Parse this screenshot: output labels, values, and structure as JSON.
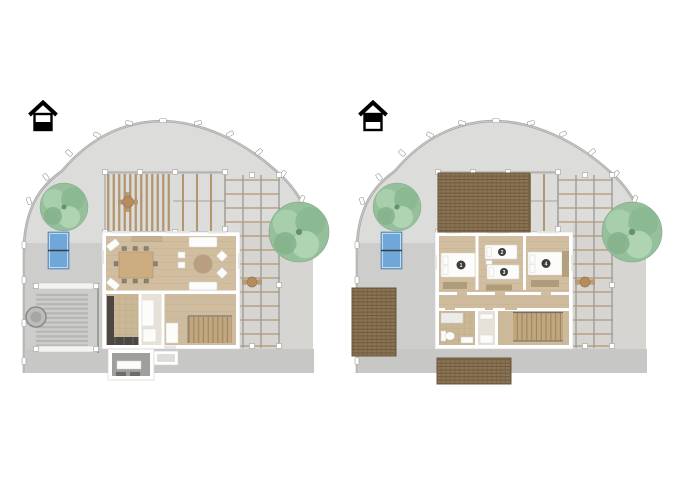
{
  "view": {
    "description": "Two 3D floor plans of a house on a fenced curved lot, side by side",
    "background": "#ffffff"
  },
  "floor_selector": {
    "ground": {
      "icon": "house-ground-floor-icon"
    },
    "upper": {
      "icon": "house-upper-floor-icon"
    }
  },
  "floors": [
    {
      "id": "ground-floor",
      "features": [
        "living-dining-room",
        "kitchen",
        "staircase",
        "entry-porch",
        "pergola",
        "trellis",
        "slat-carport",
        "table-tennis-table",
        "trees"
      ],
      "beds": []
    },
    {
      "id": "upper-floor",
      "features": [
        "bedroom-1",
        "bedroom-2-3",
        "bedroom-4",
        "bathroom",
        "staircase",
        "roof-sections",
        "pergola",
        "trellis",
        "table-tennis-table",
        "trees"
      ],
      "beds": [
        {
          "number": "1"
        },
        {
          "number": "2"
        },
        {
          "number": "3"
        },
        {
          "number": "4"
        }
      ]
    }
  ],
  "colors": {
    "paving_light": "#dcdcda",
    "paving_medium": "#cdcdcb",
    "paving_dark": "#c7c7c5",
    "paving_right": "#d6d5d1",
    "fence_gray": "#a9a9a7",
    "tree_green": "#96c09c",
    "table_tennis_blue": "#6fa8d8",
    "wood_floor": "#d1bea0",
    "tile_floor": "#c9b795",
    "pergola_beam": "#b3966f",
    "roof_tile": "#8b7355",
    "wall_white": "#ffffff",
    "counter_dark": "#4a4744",
    "bed_badge": "#3c3c3c"
  }
}
